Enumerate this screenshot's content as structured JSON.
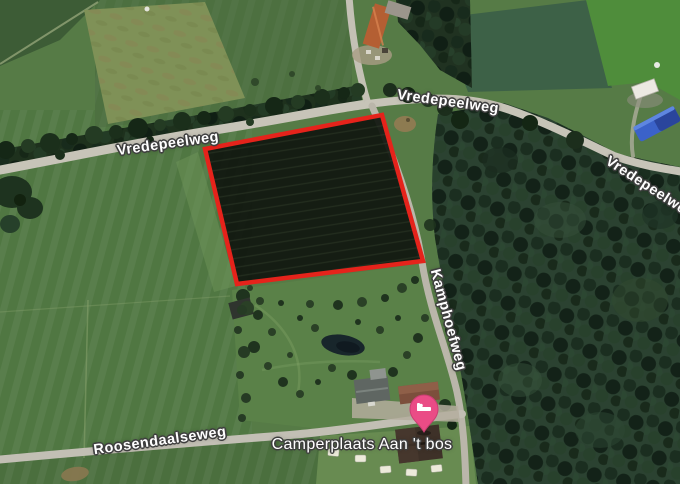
{
  "map": {
    "road_labels": [
      {
        "id": "vredepeelweg-west",
        "text": "Vredepeelweg"
      },
      {
        "id": "vredepeelweg-center",
        "text": "Vredepeelweg"
      },
      {
        "id": "vredepeelweg-east",
        "text": "Vredepeelweg"
      },
      {
        "id": "kamphoefweg",
        "text": "Kamphoefweg"
      },
      {
        "id": "roosendaalseweg",
        "text": "Roosendaalseweg"
      }
    ],
    "place": {
      "label": "Camperplaats Aan 't bos"
    },
    "marker": {
      "name": "lodging-pin",
      "glyph": "bed-icon",
      "color": "#EA4C86"
    },
    "highlight": {
      "color": "#E5231B",
      "fill": "#10160F",
      "points": "205,149 382,115 423,261 237,284"
    },
    "palette": {
      "field_green": "#567B46",
      "field_light": "#7F9157",
      "forest_dark": "#2B4231",
      "road_gray": "#C7C4B8",
      "tarp_blue": "#3B62C9",
      "roof_orange": "#B45F33"
    }
  }
}
